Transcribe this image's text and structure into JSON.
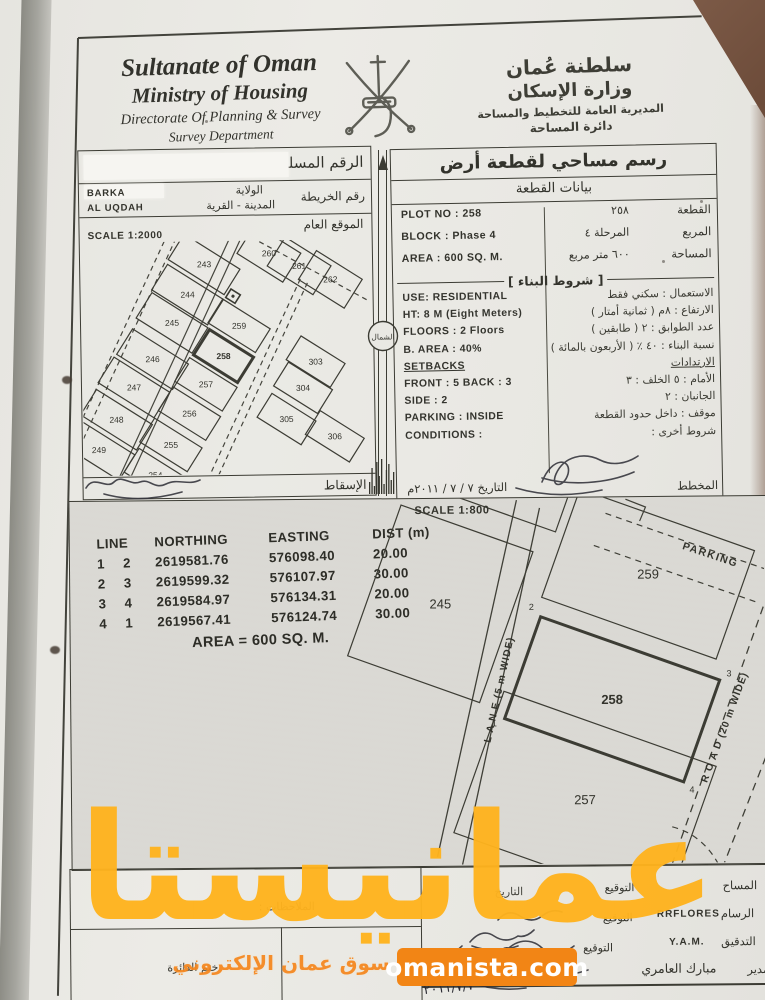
{
  "meta": {
    "doc_type": "land-survey-plot-scan"
  },
  "watermark": {
    "big_text": "عمانيستا",
    "subtitle": "سوق عمان الإلكتروني",
    "badge_text": "omanista.com",
    "big_color": "#ffb31e",
    "subtitle_color": "#f5861c",
    "badge_bg": "#f28515"
  },
  "header": {
    "en_line1": "Sultanate of Oman",
    "en_line2": "Ministry of Housing",
    "en_line3": "Directorate Of Planning & Survey",
    "en_line4": "Survey Department",
    "ar_line1": "سلطنة عُمان",
    "ar_line2": "وزارة الإسكان",
    "ar_line3": "المديرية العامة للتخطيط والمساحة",
    "ar_line4": "دائرة المساحة",
    "emblem": "oman-national-emblem"
  },
  "serial_box": {
    "serial_label": "الرقم المسلسل",
    "map_no_label": "رقم الخريطة",
    "wilayat_label": "الولاية",
    "city_label": "المدينة - القرية",
    "wilayat_value": "BARKA",
    "village_value": "AL UQDAH",
    "location_label": "الموقع العام",
    "scale_label": "SCALE 1:2000",
    "projection_label": "الإسقاط",
    "north_label": "الشمال"
  },
  "site_map": {
    "bold_plot": "258",
    "plots": [
      {
        "n": "243",
        "cx": 123,
        "cy": 23,
        "w": 66,
        "h": 30
      },
      {
        "n": "244",
        "cx": 106,
        "cy": 53,
        "w": 66,
        "h": 30
      },
      {
        "n": "245",
        "cx": 90,
        "cy": 81,
        "w": 66,
        "h": 30
      },
      {
        "n": "246",
        "cx": 70,
        "cy": 117,
        "w": 66,
        "h": 30
      },
      {
        "n": "247",
        "cx": 51,
        "cy": 145,
        "w": 66,
        "h": 30
      },
      {
        "n": "248",
        "cx": 33,
        "cy": 177,
        "w": 66,
        "h": 30
      },
      {
        "n": "249",
        "cx": 15,
        "cy": 207,
        "w": 66,
        "h": 30
      },
      {
        "n": "260",
        "cx": 188,
        "cy": 13,
        "w": 54,
        "h": 34
      },
      {
        "n": "261",
        "cx": 218,
        "cy": 26,
        "w": 54,
        "h": 34
      },
      {
        "n": "262",
        "cx": 249,
        "cy": 40,
        "w": 54,
        "h": 34
      },
      {
        "n": "259",
        "cx": 157,
        "cy": 85,
        "w": 56,
        "h": 28
      },
      {
        "n": "258",
        "cx": 141,
        "cy": 115,
        "w": 52,
        "h": 30,
        "b": true
      },
      {
        "n": "257",
        "cx": 123,
        "cy": 143,
        "w": 56,
        "h": 28
      },
      {
        "n": "256",
        "cx": 106,
        "cy": 172,
        "w": 56,
        "h": 28
      },
      {
        "n": "255",
        "cx": 87,
        "cy": 203,
        "w": 56,
        "h": 28
      },
      {
        "n": "254",
        "cx": 71,
        "cy": 233,
        "w": 56,
        "h": 28
      },
      {
        "n": "303",
        "cx": 233,
        "cy": 122,
        "w": 52,
        "h": 28
      },
      {
        "n": "304",
        "cx": 220,
        "cy": 148,
        "w": 52,
        "h": 28
      },
      {
        "n": "305",
        "cx": 203,
        "cy": 179,
        "w": 52,
        "h": 28
      },
      {
        "n": "306",
        "cx": 251,
        "cy": 197,
        "w": 52,
        "h": 28
      }
    ]
  },
  "plot_panel": {
    "title": "رسم مساحي لقطعة أرض",
    "subtitle": "بيانات القطعة",
    "rows": [
      {
        "ar_label": "القطعة",
        "ar_value": "٢٥٨",
        "en": "PLOT NO : 258"
      },
      {
        "ar_label": "المربع",
        "ar_value": "المرحلة ٤",
        "en": "BLOCK :  Phase 4"
      },
      {
        "ar_label": "المساحة",
        "ar_value": "٦٠٠  متر مربع",
        "en": "AREA :  600 SQ. M."
      }
    ],
    "conditions_header": "شروط البناء",
    "conditions": [
      {
        "en": "USE: RESIDENTIAL",
        "ar": "الاستعمال :  سكني فقط"
      },
      {
        "en": "HT: 8 M  (Eight Meters)",
        "ar": "الارتفاع :  ٨م  ( ثمانية أمتار )"
      },
      {
        "en": "FLOORS :  2 Floors",
        "ar": "عدد الطوابق :  ٢  ( طابقين )"
      },
      {
        "en": "B. AREA :   40%",
        "ar": "نسبة البناء :  ٤٠ ٪  ( الأربعون بالمائة )"
      },
      {
        "en": "SETBACKS",
        "ar": "الارتدادات",
        "u": true
      },
      {
        "en": "FRONT : 5      BACK : 3",
        "ar": "الأمام :  ٥        الخلف :  ٣"
      },
      {
        "en": "SIDE :   2",
        "ar": "الجانبان :  ٢"
      },
      {
        "en": "PARKING :  INSIDE",
        "ar": "موقف :  داخل حدود القطعة"
      },
      {
        "en": "CONDITIONS :",
        "ar": "شروط أخرى :"
      }
    ],
    "planner_label": "المخطط",
    "date_note": "التاريخ  ٧ / ٧ / ٢٠١١م"
  },
  "coords_table": {
    "headers": [
      "LINE",
      "NORTHING",
      "EASTING",
      "DIST (m)"
    ],
    "rows": [
      [
        "1",
        "2",
        "2619581.76",
        "576098.40",
        "20.00"
      ],
      [
        "2",
        "3",
        "2619599.32",
        "576107.97",
        "30.00"
      ],
      [
        "3",
        "4",
        "2619584.97",
        "576134.31",
        "20.00"
      ],
      [
        "4",
        "1",
        "2619567.41",
        "576124.74",
        "30.00"
      ]
    ],
    "area_line": "AREA = 600 SQ. M."
  },
  "detail_map": {
    "scale_label": "SCALE 1:800",
    "parking_label": "PARKING",
    "lane_label": "L A N E  (5 m WIDE)",
    "road_label": "R O A D (20 m WIDE)",
    "plots": [
      {
        "n": "245",
        "cx": 370,
        "cy": 105,
        "w": 140,
        "h": 160,
        "a": 20
      },
      {
        "n": "",
        "cx": 430,
        "cy": -32,
        "w": 150,
        "h": 86,
        "a": 20
      },
      {
        "n": "259",
        "cx": 578,
        "cy": 77,
        "w": 185,
        "h": 115,
        "a": 20
      },
      {
        "n": "258",
        "cx": 541,
        "cy": 202,
        "w": 190,
        "h": 108,
        "a": 20,
        "b": true
      },
      {
        "n": "257",
        "cx": 513,
        "cy": 302,
        "w": 225,
        "h": 150,
        "a": 20
      }
    ],
    "corner_points": [
      {
        "t": "2",
        "x": 461,
        "y": 112
      },
      {
        "t": "3",
        "x": 658,
        "y": 180
      },
      {
        "t": "4",
        "x": 620,
        "y": 296
      },
      {
        "t": "1",
        "x": 423,
        "y": 228
      }
    ]
  },
  "signatures": {
    "surveyor_label": "المساح",
    "draftsman_label": "الرسام",
    "draftsman_value": "RRFLORES",
    "check_label": "التدقيق",
    "check_value": "Y.A.M.",
    "director_label": "المدير",
    "director_value": "مبارك العامري",
    "sign_label": "التوقيع",
    "date_label": "التاريخ",
    "date_value": "٢٠١١/٧/٧"
  },
  "stamp_box": {
    "notes_label": "الملاحظات :",
    "stamp_label": "ختم الدائرة"
  },
  "handwritten": {
    "serial_date": "التاريخ  ٧ / ٧ / ٢٠١١م"
  }
}
